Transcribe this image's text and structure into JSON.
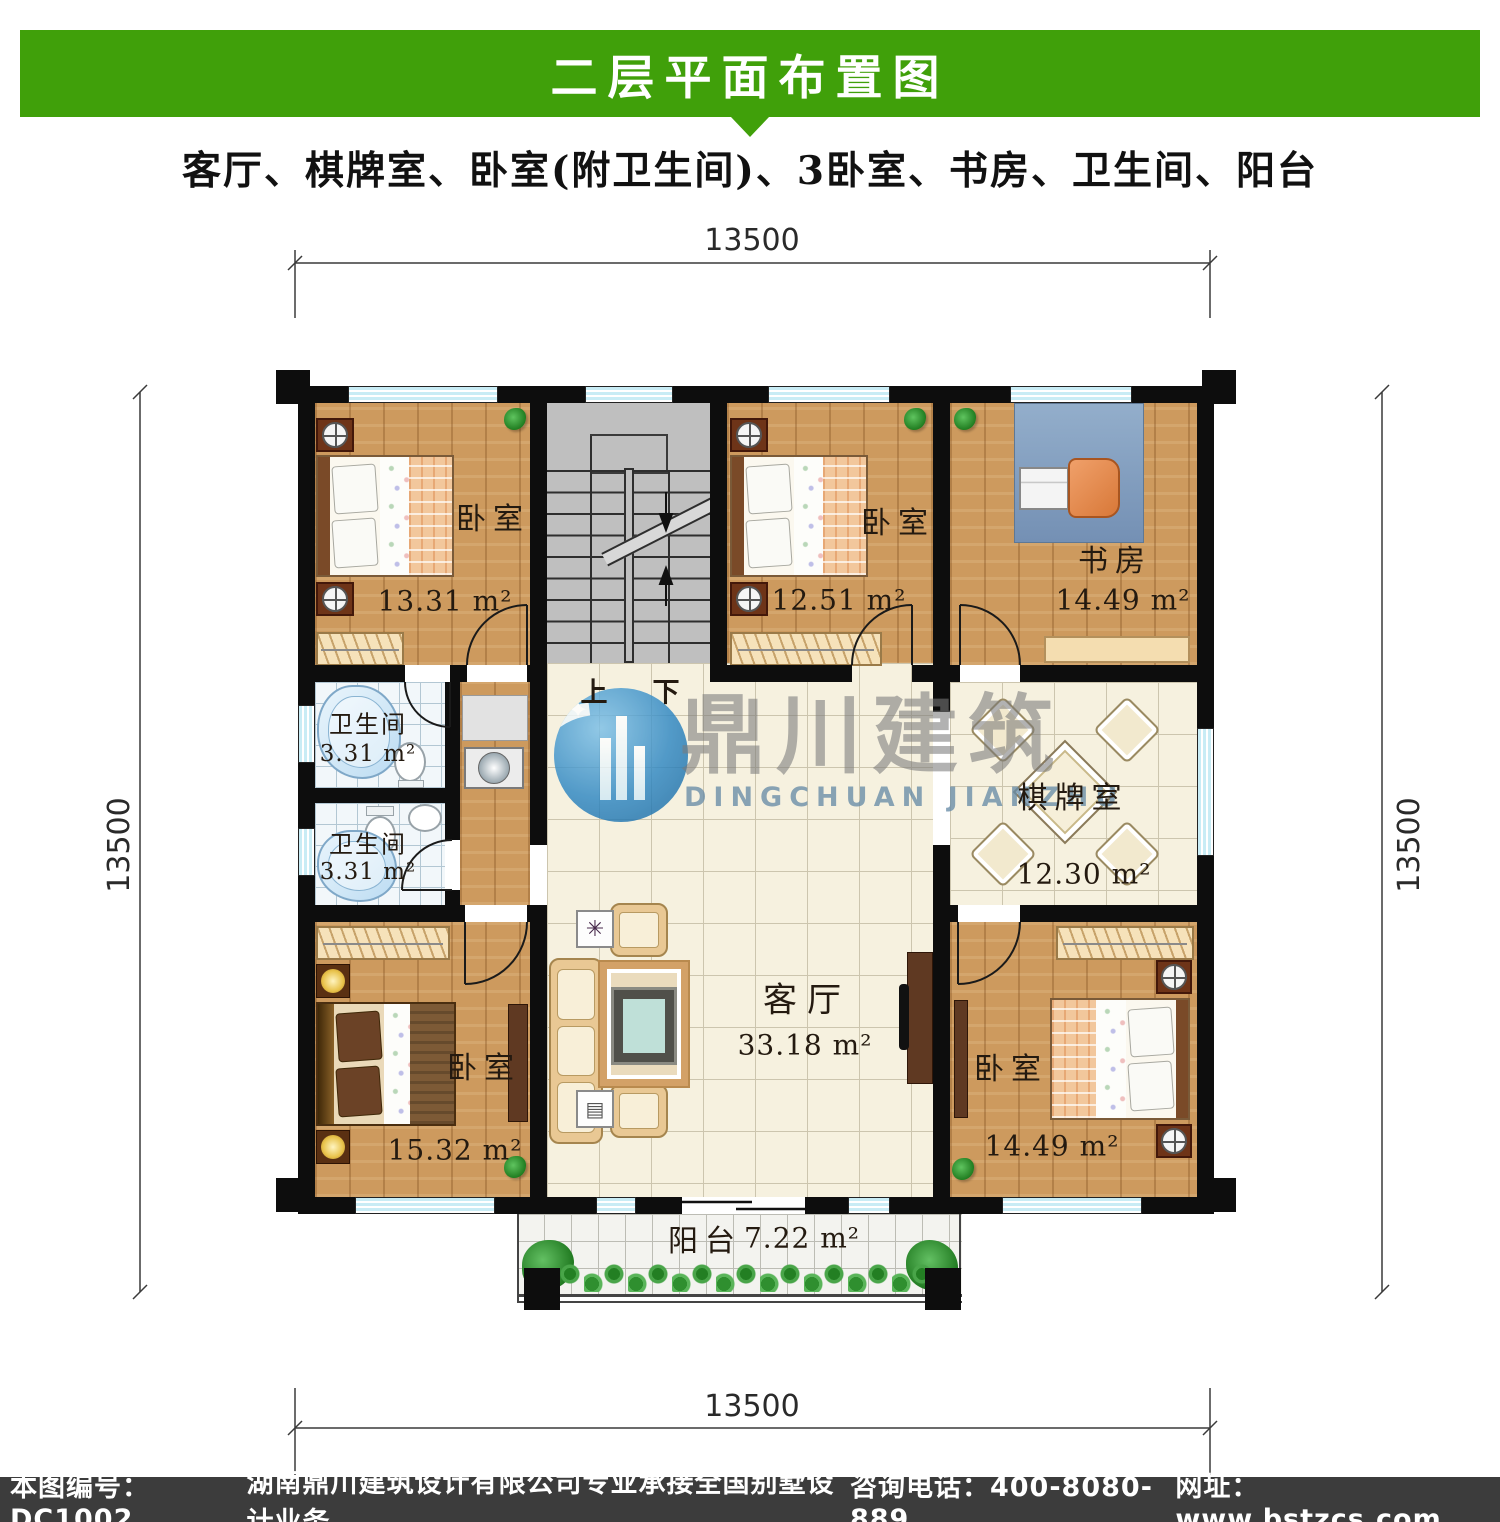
{
  "header": {
    "title": "二层平面布置图",
    "subtitle": "客厅、棋牌室、卧室(附卫生间)、3卧室、书房、卫生间、阳台"
  },
  "dimensions": {
    "top": "13500",
    "bottom": "13500",
    "left": "13500",
    "right": "13500"
  },
  "rooms": [
    {
      "name": "卧室",
      "area": "13.31 m²"
    },
    {
      "name": "卧室",
      "area": "12.51 m²"
    },
    {
      "name": "书房",
      "area": "14.49 m²"
    },
    {
      "name": "卫生间",
      "area": "3.31 m²"
    },
    {
      "name": "卫生间",
      "area": "3.31 m²"
    },
    {
      "name": "棋牌室",
      "area": "12.30 m²"
    },
    {
      "name": "客厅",
      "area": "33.18 m²"
    },
    {
      "name": "卧室",
      "area": "15.32 m²"
    },
    {
      "name": "卧室",
      "area": "14.49 m²"
    },
    {
      "name": "阳台",
      "area": "7.22 m²"
    }
  ],
  "stairs": {
    "up": "上",
    "down": "下"
  },
  "watermark": {
    "name": "鼎川建筑",
    "sub": "DINGCHUAN JIANZHU"
  },
  "footer": {
    "items": [
      "本图编号：DC1002",
      "湖南鼎川建筑设计有限公司专业承接全国别墅设计业务",
      "咨询电话：400-8080-889",
      "网址：www.bstzcs.com"
    ]
  },
  "icons": {
    "watermark_logo": "building-circle-logo",
    "plant": "plant-icon",
    "stairs_up_arrow": "arrow-up-icon",
    "stairs_down_arrow": "arrow-down-icon"
  },
  "colors": {
    "banner_green": "#40a00a",
    "footer_gray": "#3c3c3c",
    "window_cyan": "#c8ecf5"
  }
}
